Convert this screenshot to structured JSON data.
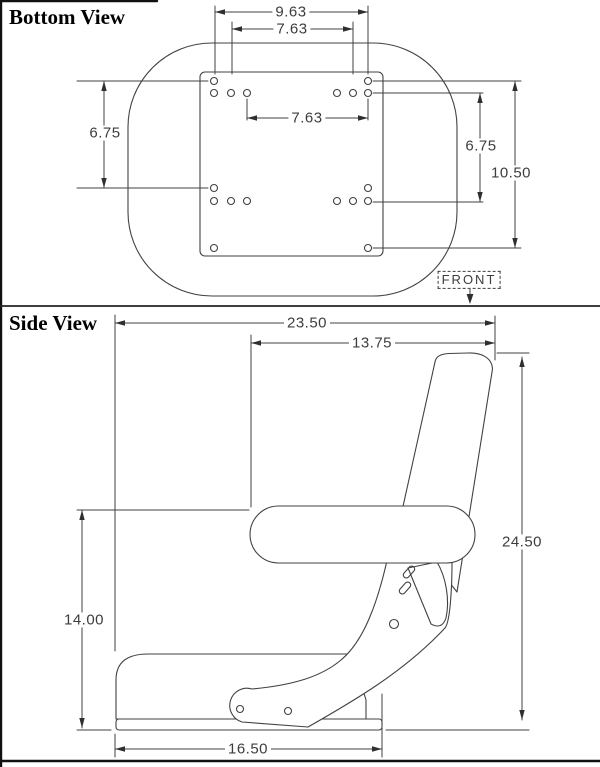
{
  "drawing": {
    "line_color": "#424242",
    "border_color": "#111111",
    "background": "#ffffff"
  },
  "bottom_view": {
    "title": "Bottom View",
    "front_label": "FRONT",
    "dim_outer_hole_width": "9.63",
    "dim_inner_hole_width_top": "7.63",
    "dim_inner_hole_width_mid": "7.63",
    "dim_hole_height_left": "6.75",
    "dim_hole_height_right": "6.75",
    "dim_hole_height_total": "10.50"
  },
  "side_view": {
    "title": "Side View",
    "dim_overall_depth": "23.50",
    "dim_backrest_to_armrest_front": "13.75",
    "dim_overall_height": "24.50",
    "dim_armrest_height": "14.00",
    "dim_base_length": "16.50"
  }
}
